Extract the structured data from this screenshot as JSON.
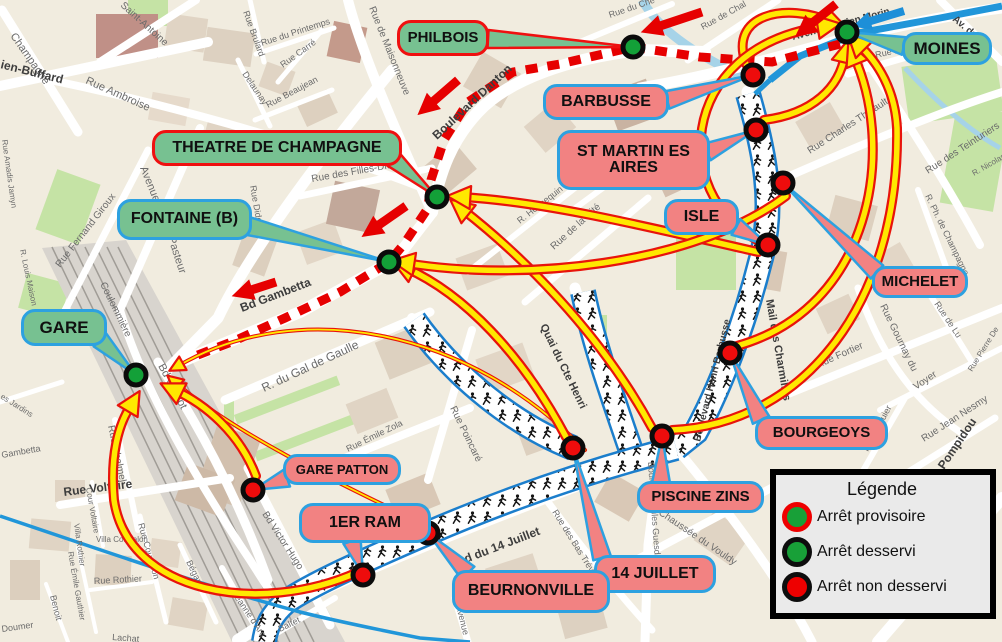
{
  "legend": {
    "title": "Légende",
    "items": [
      {
        "label": "Arrêt provisoire",
        "fill": "#18a038",
        "ring": "#ee0000"
      },
      {
        "label": "Arrêt desservi",
        "fill": "#18a038",
        "ring": "#0d0d0d"
      },
      {
        "label": "Arrêt non desservi",
        "fill": "#ee0000",
        "ring": "#0d0d0d"
      }
    ]
  },
  "colors": {
    "served_stop": "#13a038",
    "closed_stop": "#ee0c0c",
    "callout_green": "#77c191",
    "callout_red": "#f28282",
    "border_red": "#ef1010",
    "border_blue": "#2da1e0",
    "deviation_route": "#e60000",
    "bus_route_blue": "#2196d9",
    "race_corridor_edge": "#1b7ecc",
    "arrow_yellow": "#ffe800",
    "arrow_outline": "#e8140c"
  },
  "stops": [
    {
      "id": "philbois-stop",
      "type": "served",
      "x": 633,
      "y": 47
    },
    {
      "id": "moines-stop",
      "type": "served",
      "x": 847,
      "y": 32
    },
    {
      "id": "theatre-stop",
      "type": "served",
      "x": 437,
      "y": 197
    },
    {
      "id": "fontaine-stop",
      "type": "served",
      "x": 389,
      "y": 262
    },
    {
      "id": "gare-stop",
      "type": "served",
      "x": 136,
      "y": 375
    },
    {
      "id": "barbusse-stop",
      "type": "closed",
      "x": 753,
      "y": 75
    },
    {
      "id": "st-martin-stop",
      "type": "closed",
      "x": 756,
      "y": 130
    },
    {
      "id": "michelet-stop",
      "type": "closed",
      "x": 783,
      "y": 183
    },
    {
      "id": "isle-stop",
      "type": "closed",
      "x": 768,
      "y": 245
    },
    {
      "id": "bourgeoys-stop",
      "type": "closed",
      "x": 730,
      "y": 353
    },
    {
      "id": "piscine-zins-stop",
      "type": "closed",
      "x": 662,
      "y": 436
    },
    {
      "id": "quatorze-juillet-stop",
      "type": "closed",
      "x": 573,
      "y": 448
    },
    {
      "id": "beurnonville-stop",
      "type": "closed",
      "x": 428,
      "y": 533
    },
    {
      "id": "premier-ram-stop",
      "type": "closed",
      "x": 363,
      "y": 575
    },
    {
      "id": "gare-patton-stop",
      "type": "closed",
      "x": 253,
      "y": 490
    }
  ],
  "callouts": [
    {
      "id": "philbois",
      "label": "PHILBOIS",
      "kind": "served",
      "border": "#ef1010",
      "x": 397,
      "y": 20,
      "w": 92,
      "h": 36,
      "fs": 15,
      "base": [
        488,
        39
      ],
      "stop": [
        633,
        47
      ]
    },
    {
      "id": "theatre-de-champagne",
      "label": "THEATRE DE CHAMPAGNE",
      "kind": "served",
      "border": "#ef1010",
      "x": 152,
      "y": 130,
      "w": 250,
      "h": 36,
      "fs": 16,
      "base": [
        392,
        158
      ],
      "stop": [
        437,
        197
      ]
    },
    {
      "id": "fontaine-b",
      "label": "FONTAINE (B)",
      "kind": "served",
      "border": "#2da1e0",
      "x": 117,
      "y": 199,
      "w": 135,
      "h": 41,
      "fs": 16,
      "base": [
        248,
        226
      ],
      "stop": [
        389,
        262
      ]
    },
    {
      "id": "gare",
      "label": "GARE",
      "kind": "served",
      "border": "#2da1e0",
      "x": 21,
      "y": 309,
      "w": 86,
      "h": 37,
      "fs": 17,
      "base": [
        100,
        340
      ],
      "stop": [
        136,
        375
      ]
    },
    {
      "id": "moines",
      "label": "MOINES",
      "kind": "served",
      "border": "#2da1e0",
      "x": 902,
      "y": 32,
      "w": 90,
      "h": 33,
      "fs": 17,
      "base": [
        904,
        46
      ],
      "stop": [
        847,
        32
      ]
    },
    {
      "id": "barbusse",
      "label": "BARBUSSE",
      "kind": "closed",
      "border": "#2da1e0",
      "x": 543,
      "y": 84,
      "w": 126,
      "h": 36,
      "fs": 16,
      "base": [
        667,
        100
      ],
      "stop": [
        753,
        75
      ]
    },
    {
      "id": "st-martin-es-aires",
      "label": "ST MARTIN ES AIRES",
      "kind": "closed",
      "border": "#2da1e0",
      "x": 557,
      "y": 130,
      "w": 153,
      "h": 60,
      "fs": 16,
      "base": [
        707,
        152
      ],
      "stop": [
        756,
        130
      ]
    },
    {
      "id": "isle",
      "label": "ISLE",
      "kind": "closed",
      "border": "#2da1e0",
      "x": 664,
      "y": 199,
      "w": 75,
      "h": 36,
      "fs": 16,
      "base": [
        736,
        227
      ],
      "stop": [
        768,
        245
      ]
    },
    {
      "id": "michelet",
      "label": "MICHELET",
      "kind": "closed",
      "border": "#2da1e0",
      "x": 872,
      "y": 266,
      "w": 96,
      "h": 32,
      "fs": 15,
      "base": [
        877,
        272
      ],
      "stop": [
        783,
        183
      ]
    },
    {
      "id": "bourgeoys",
      "label": "BOURGEOYS",
      "kind": "closed",
      "border": "#2da1e0",
      "x": 755,
      "y": 416,
      "w": 133,
      "h": 34,
      "fs": 15,
      "base": [
        761,
        420
      ],
      "stop": [
        730,
        353
      ]
    },
    {
      "id": "piscine-zins",
      "label": "PISCINE ZINS",
      "kind": "closed",
      "border": "#2da1e0",
      "x": 637,
      "y": 481,
      "w": 127,
      "h": 32,
      "fs": 15,
      "base": [
        661,
        483
      ],
      "stop": [
        662,
        436
      ]
    },
    {
      "id": "quatorze-juillet",
      "label": "14 JUILLET",
      "kind": "closed",
      "border": "#2da1e0",
      "x": 594,
      "y": 555,
      "w": 122,
      "h": 38,
      "fs": 16,
      "base": [
        602,
        558
      ],
      "stop": [
        573,
        448
      ]
    },
    {
      "id": "beurnonville",
      "label": "BEURNONVILLE",
      "kind": "closed",
      "border": "#2da1e0",
      "x": 452,
      "y": 570,
      "w": 158,
      "h": 43,
      "fs": 16,
      "base": [
        468,
        573
      ],
      "stop": [
        428,
        533
      ]
    },
    {
      "id": "premier-ram",
      "label": "1ER RAM",
      "kind": "closed",
      "border": "#2da1e0",
      "x": 299,
      "y": 503,
      "w": 132,
      "h": 40,
      "fs": 16,
      "base": [
        352,
        541
      ],
      "stop": [
        363,
        575
      ]
    },
    {
      "id": "gare-patton",
      "label": "GARE PATTON",
      "kind": "closed",
      "border": "#2da1e0",
      "x": 283,
      "y": 454,
      "w": 118,
      "h": 31,
      "fs": 13,
      "base": [
        287,
        478
      ],
      "stop": [
        253,
        490
      ]
    }
  ],
  "street_labels": [
    {
      "t": "Champagne",
      "x": 10,
      "y": 36,
      "r": 55,
      "s": 11
    },
    {
      "t": "ien-Buffard",
      "x": 0,
      "y": 68,
      "r": 14,
      "s": 12,
      "b": 1
    },
    {
      "t": "Rue Ambroise",
      "x": 85,
      "y": 83,
      "r": 24,
      "s": 11
    },
    {
      "t": "Saint-Antoine",
      "x": 120,
      "y": 6,
      "r": 42,
      "s": 10
    },
    {
      "t": "Rue du Printemps",
      "x": 262,
      "y": 46,
      "r": -18,
      "s": 9
    },
    {
      "t": "Rue Brulard",
      "x": 243,
      "y": 12,
      "r": 70,
      "s": 9
    },
    {
      "t": "Rue Carré",
      "x": 283,
      "y": 68,
      "r": -36,
      "s": 9
    },
    {
      "t": "Delaunay",
      "x": 242,
      "y": 74,
      "r": 56,
      "s": 9
    },
    {
      "t": "Rue Beaujean",
      "x": 268,
      "y": 108,
      "r": -28,
      "s": 9
    },
    {
      "t": "Rue de Maisonneuve",
      "x": 369,
      "y": 8,
      "r": 68,
      "s": 10
    },
    {
      "t": "Boulevard Danton",
      "x": 437,
      "y": 140,
      "r": -43,
      "s": 12,
      "b": 1
    },
    {
      "t": "Rue des Filles-Dieu",
      "x": 312,
      "y": 182,
      "r": -10,
      "s": 10
    },
    {
      "t": "Rue Dide",
      "x": 250,
      "y": 186,
      "r": 80,
      "s": 9
    },
    {
      "t": "Avenue",
      "x": 140,
      "y": 168,
      "r": 68,
      "s": 11
    },
    {
      "t": "Pasteur",
      "x": 168,
      "y": 238,
      "r": 72,
      "s": 11
    },
    {
      "t": "Rue Fernand Giroux",
      "x": 60,
      "y": 268,
      "r": -52,
      "s": 10
    },
    {
      "t": "R. Louis Maison",
      "x": 20,
      "y": 250,
      "r": 78,
      "s": 8
    },
    {
      "t": "Rue Amadis Jamyn",
      "x": 2,
      "y": 140,
      "r": 82,
      "s": 8
    },
    {
      "t": "es Jardins",
      "x": 0,
      "y": 398,
      "r": 32,
      "s": 8
    },
    {
      "t": "Coulommière",
      "x": 100,
      "y": 284,
      "r": 64,
      "s": 10
    },
    {
      "t": "Bd Carnot",
      "x": 158,
      "y": 366,
      "r": 62,
      "s": 11
    },
    {
      "t": "Rue Chalmel",
      "x": 108,
      "y": 426,
      "r": 78,
      "s": 10
    },
    {
      "t": "Bd Gambetta",
      "x": 242,
      "y": 312,
      "r": -21,
      "s": 12,
      "b": 1
    },
    {
      "t": "R. du Gal de Gaulle",
      "x": 264,
      "y": 392,
      "r": -25,
      "s": 12
    },
    {
      "t": "Rue Voltaire",
      "x": 64,
      "y": 496,
      "r": -7,
      "s": 12,
      "b": 1
    },
    {
      "t": "Cour Voltaire",
      "x": 86,
      "y": 488,
      "r": 80,
      "s": 8
    },
    {
      "t": "Villa Courtalon",
      "x": 96,
      "y": 542,
      "r": 0,
      "s": 8
    },
    {
      "t": "Villa Rothier",
      "x": 74,
      "y": 524,
      "r": 82,
      "s": 8
    },
    {
      "t": "Rue Émile Gauthier",
      "x": 68,
      "y": 552,
      "r": 80,
      "s": 8
    },
    {
      "t": "Rue Rothier",
      "x": 94,
      "y": 584,
      "r": -3,
      "s": 9
    },
    {
      "t": "Rue Courtalon",
      "x": 138,
      "y": 524,
      "r": 74,
      "s": 9
    },
    {
      "t": "Bégand",
      "x": 186,
      "y": 562,
      "r": 64,
      "s": 9
    },
    {
      "t": "Benoit",
      "x": 50,
      "y": 596,
      "r": 76,
      "s": 9
    },
    {
      "t": "Doumer",
      "x": 2,
      "y": 632,
      "r": -8,
      "s": 9
    },
    {
      "t": "Gambetta",
      "x": 2,
      "y": 458,
      "r": -10,
      "s": 9
    },
    {
      "t": "Jeanne d'Arc",
      "x": 232,
      "y": 594,
      "r": 56,
      "s": 9
    },
    {
      "t": "Lachat",
      "x": 112,
      "y": 640,
      "r": 4,
      "s": 9
    },
    {
      "t": "Baltet",
      "x": 280,
      "y": 632,
      "r": -26,
      "s": 9
    },
    {
      "t": "Bd Victor Hugo",
      "x": 262,
      "y": 514,
      "r": 57,
      "s": 10
    },
    {
      "t": "Rue Émile Zola",
      "x": 348,
      "y": 452,
      "r": -26,
      "s": 9
    },
    {
      "t": "Rue Poincaré",
      "x": 450,
      "y": 408,
      "r": 64,
      "s": 10
    },
    {
      "t": "Bd du 14 Juillet",
      "x": 458,
      "y": 566,
      "r": -21,
      "s": 12,
      "b": 1
    },
    {
      "t": "Rue des Bas Trévois",
      "x": 552,
      "y": 512,
      "r": 58,
      "s": 9
    },
    {
      "t": "Quai du Cte Henri",
      "x": 540,
      "y": 326,
      "r": 64,
      "s": 11,
      "b": 1
    },
    {
      "t": "R. Hennequin",
      "x": 520,
      "y": 224,
      "r": -38,
      "s": 9
    },
    {
      "t": "Rue de la Cité",
      "x": 554,
      "y": 250,
      "r": -42,
      "s": 10
    },
    {
      "t": "Rue Girardon",
      "x": 580,
      "y": 182,
      "r": -33,
      "s": 9
    },
    {
      "t": "Boulevard Henri Barbusse",
      "x": 700,
      "y": 442,
      "r": -76,
      "s": 10,
      "b": 1
    },
    {
      "t": "Mail des Charmilles",
      "x": 766,
      "y": 300,
      "r": 80,
      "s": 11,
      "b": 1
    },
    {
      "t": "Boulevard Jules Guesde",
      "x": 648,
      "y": 462,
      "r": 86,
      "s": 9
    },
    {
      "t": "Chaussée du Vouldy",
      "x": 658,
      "y": 514,
      "r": 34,
      "s": 10
    },
    {
      "t": "Avenue Lucien Morin",
      "x": 793,
      "y": 40,
      "r": -15,
      "s": 10,
      "b": 1
    },
    {
      "t": "Av. du M",
      "x": 952,
      "y": 20,
      "r": 40,
      "s": 10,
      "b": 1
    },
    {
      "t": "Rue Louis Morin",
      "x": 876,
      "y": 58,
      "r": -13,
      "s": 9
    },
    {
      "t": "Rue de Chal",
      "x": 703,
      "y": 30,
      "r": -29,
      "s": 9
    },
    {
      "t": "Rue du Che",
      "x": 610,
      "y": 18,
      "r": -19,
      "s": 9
    },
    {
      "t": "Rue Charles Thibault",
      "x": 810,
      "y": 154,
      "r": -33,
      "s": 10
    },
    {
      "t": "Rue des Teinturiers",
      "x": 928,
      "y": 174,
      "r": -33,
      "s": 10
    },
    {
      "t": "R. Nicolas",
      "x": 974,
      "y": 176,
      "r": -30,
      "s": 8
    },
    {
      "t": "R. Ph. de Champagne",
      "x": 925,
      "y": 196,
      "r": 64,
      "s": 9
    },
    {
      "t": "Rue de Lu",
      "x": 934,
      "y": 304,
      "r": 56,
      "s": 9
    },
    {
      "t": "Rue Gournay du",
      "x": 880,
      "y": 306,
      "r": 64,
      "s": 10
    },
    {
      "t": "Voyer",
      "x": 916,
      "y": 390,
      "r": -34,
      "s": 10
    },
    {
      "t": "Rue Fortier",
      "x": 818,
      "y": 368,
      "r": -24,
      "s": 10
    },
    {
      "t": "Rue Huguier",
      "x": 868,
      "y": 452,
      "r": -62,
      "s": 9
    },
    {
      "t": "Rue Jean Nesmy",
      "x": 924,
      "y": 442,
      "r": -33,
      "s": 10
    },
    {
      "t": "Pompidou",
      "x": 944,
      "y": 470,
      "r": -56,
      "s": 12,
      "b": 1
    },
    {
      "t": "Rue Pierre De",
      "x": 972,
      "y": 372,
      "r": -58,
      "s": 8
    },
    {
      "t": "Avenue",
      "x": 456,
      "y": 606,
      "r": 76,
      "s": 9
    }
  ]
}
